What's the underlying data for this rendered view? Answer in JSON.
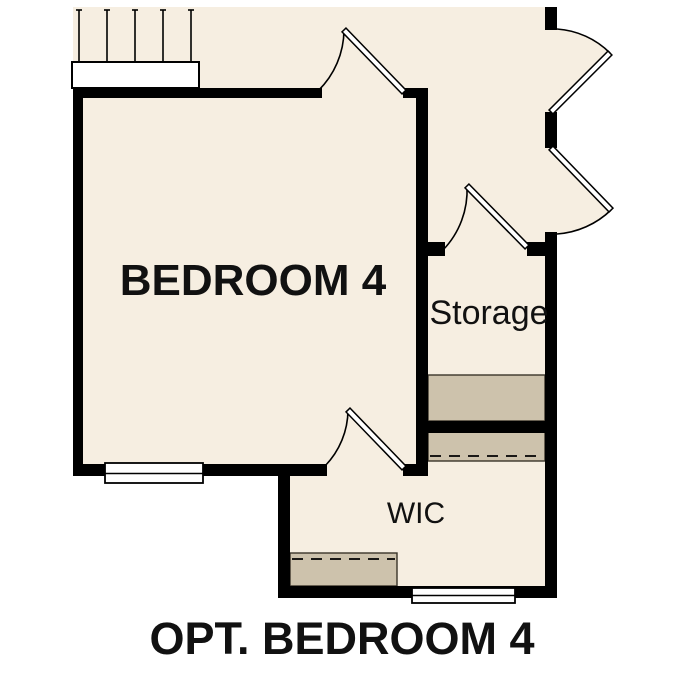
{
  "plan": {
    "caption": "OPT. BEDROOM 4",
    "rooms": [
      {
        "id": "bedroom4",
        "label": "BEDROOM 4"
      },
      {
        "id": "storage",
        "label": "Storage"
      },
      {
        "id": "wic",
        "label": "WIC"
      }
    ],
    "colors": {
      "floor": "#f6eee1",
      "wall": "#000000",
      "shelf": "#cdc2ac",
      "shelf_outline": "#3a342a",
      "line": "#000000",
      "window_fill": "#ffffff",
      "text": "#111111"
    }
  }
}
